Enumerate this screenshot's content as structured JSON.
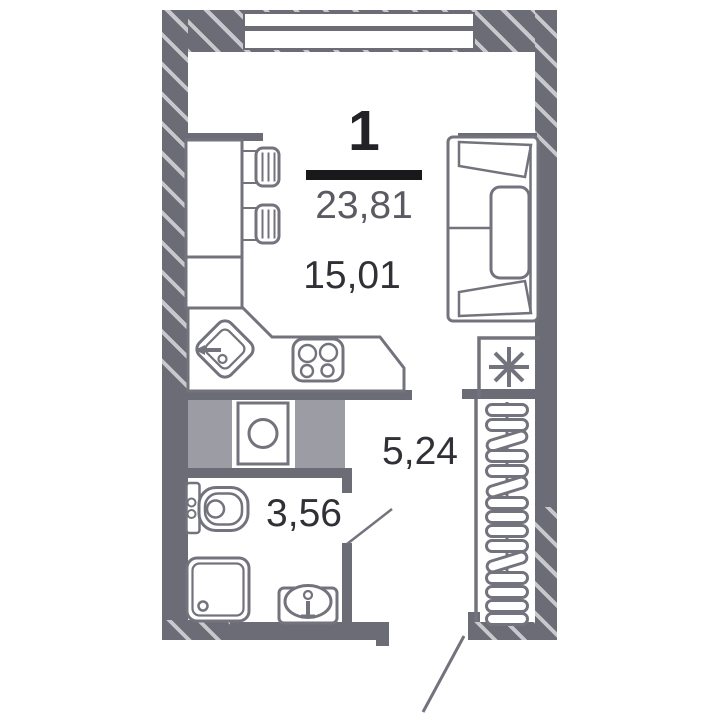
{
  "plan": {
    "rooms_count": "1",
    "total_area": "23,81",
    "rooms": [
      {
        "name": "living-kitchen",
        "area": "15,01"
      },
      {
        "name": "hallway",
        "area": "5,24"
      },
      {
        "name": "bathroom",
        "area": "3,56"
      }
    ],
    "colors": {
      "wall": "#6c6c77",
      "wall_stripe": "#c8c8cd",
      "furniture_stroke": "#73737d",
      "shaft_fill": "#9c9ca4",
      "area_text": "#303036",
      "total_text": "#5a5a63",
      "rooms_count_text": "#232327",
      "divider": "#19191c",
      "background": "#ffffff"
    },
    "icons": [
      "window",
      "sofa",
      "dining-table",
      "chair",
      "kitchen-sink",
      "stove",
      "washing-machine",
      "vent-shaft",
      "fridge-asterisk",
      "wardrobe-hangers",
      "toilet",
      "shower",
      "washbasin",
      "door-swing"
    ]
  }
}
